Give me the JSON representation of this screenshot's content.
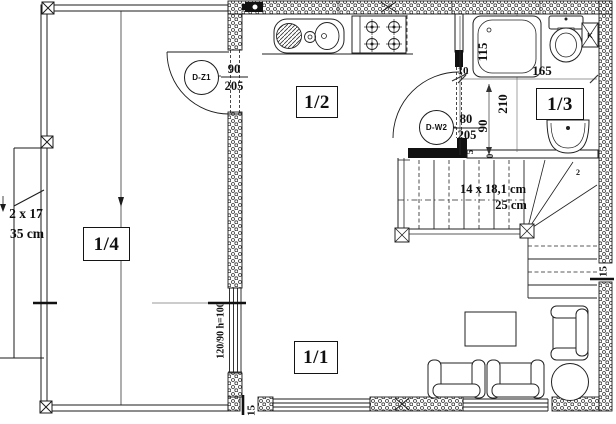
{
  "rooms": {
    "living": {
      "label": "1/1"
    },
    "kitchen_hall": {
      "label": "1/2"
    },
    "bathroom": {
      "label": "1/3"
    },
    "porch": {
      "label": "1/4"
    }
  },
  "doors": {
    "dz1": {
      "code": "D-Z1",
      "width": "90",
      "height": "205"
    },
    "dw2": {
      "code": "D-W2",
      "width": "80",
      "height": "205"
    }
  },
  "stairs": {
    "internal": {
      "dimensions": "14 x 18,1 cm",
      "tread": "25 cm",
      "note": "2"
    },
    "external": {
      "dimensions": "2 x 17",
      "tread": "35 cm"
    }
  },
  "window": {
    "mid_wall": "120/90 h=100"
  },
  "dimensions": {
    "tub_length": "115",
    "bath_width": "165",
    "hall_depth": "210",
    "door_clearance": "90",
    "wall_thickness": "10",
    "insulation_right": "15",
    "insulation_bottom": "15",
    "step_a": "5",
    "step_b": "0"
  },
  "symbols": {
    "vent": "K"
  },
  "colors": {
    "ink": "#1c1c1c",
    "paper": "#ffffff"
  }
}
